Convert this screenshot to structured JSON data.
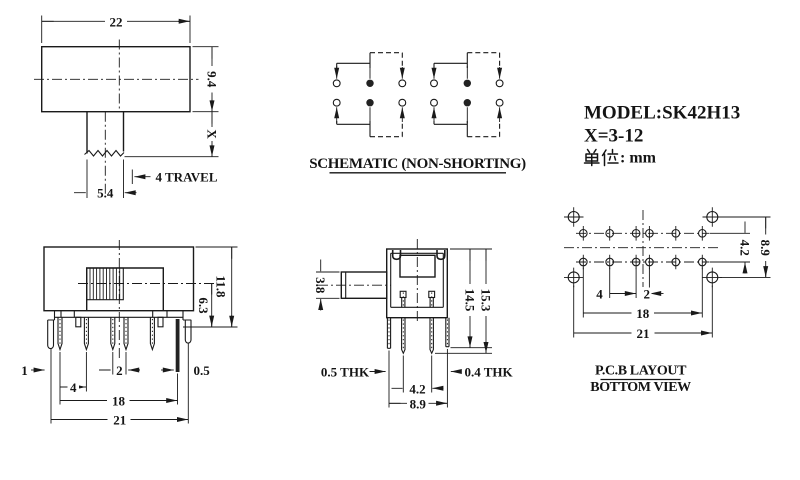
{
  "info_block": {
    "model": "MODEL:SK42H13",
    "x_range": "X=3-12",
    "unit_label": "单位: mm",
    "unit_suffix": ": mm"
  },
  "top_view": {
    "width": "22",
    "height": "9.4",
    "x_dim": "X",
    "knob_width": "5.4",
    "travel": "4 TRAVEL"
  },
  "schematic": {
    "title": "SCHEMATIC (NON-SHORTING)"
  },
  "front_view": {
    "leg_width": "1",
    "pitch": "4",
    "pitch_small": "2",
    "pin_thk": "0.5",
    "pin_span": "18",
    "total_span": "21",
    "pin_height": "6.3",
    "total_height": "11.8"
  },
  "side_view": {
    "knob_h": "3.8",
    "h_inner": "14.5",
    "h_outer": "15.3",
    "thk_left": "0.5 THK",
    "thk_right": "0.4 THK",
    "pin_gap": "4.2",
    "outer_gap": "8.9"
  },
  "pcb": {
    "title1": "P.C.B LAYOUT",
    "title2": "BOTTOM VIEW",
    "pitch": "4",
    "pitch_small": "2",
    "row_gap": "4.2",
    "mount_gap": "8.9",
    "span": "18",
    "mount_span": "21"
  }
}
